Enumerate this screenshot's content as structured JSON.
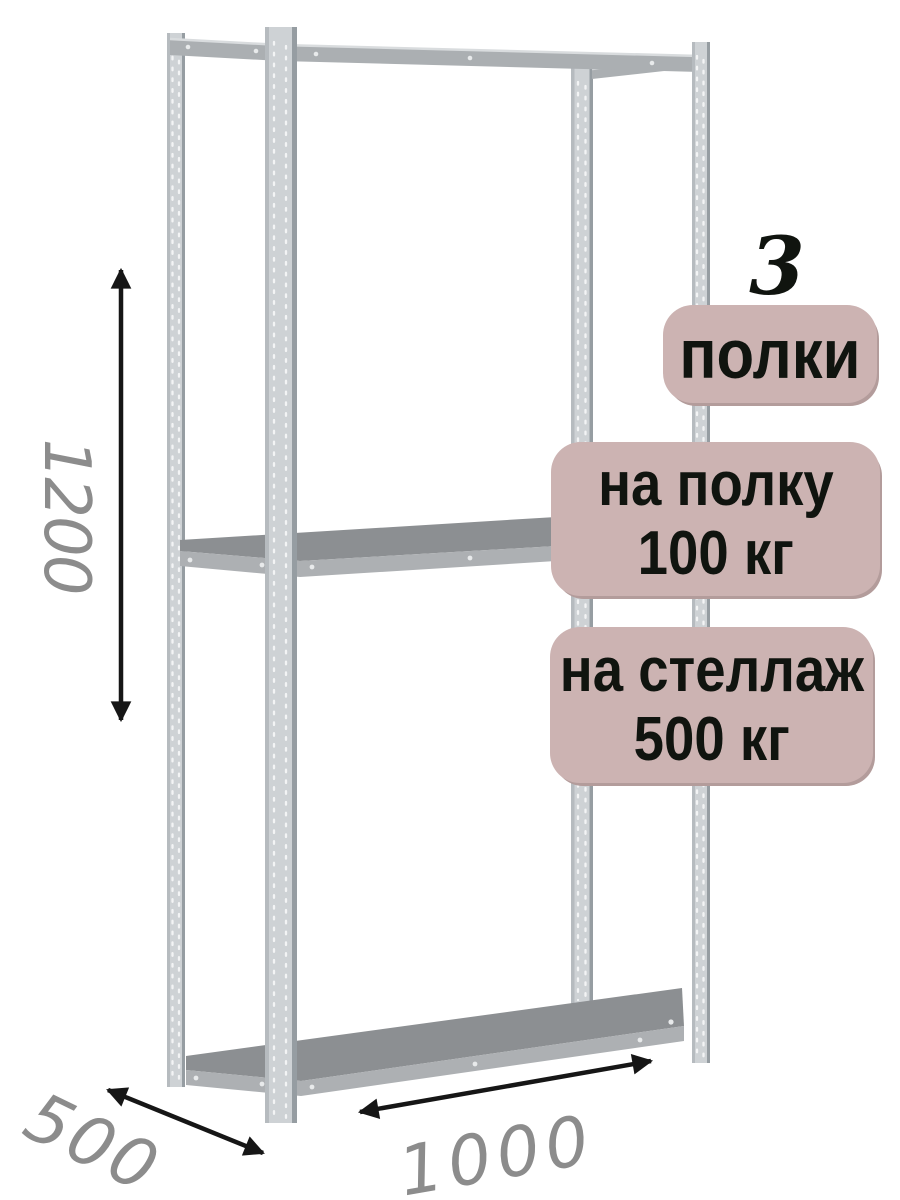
{
  "product": {
    "shelf_count": "3",
    "shelf_count_label": "полки",
    "shelf_load": {
      "line1": "на полку",
      "line2": "100 кг"
    },
    "rack_load": {
      "line1": "на стеллаж",
      "line2": "500 кг"
    }
  },
  "dimensions": {
    "height": "1200",
    "depth": "500",
    "width": "1000"
  },
  "colors": {
    "badge_bg": "#ccb3b2",
    "badge_edge": "#b39c9b",
    "badge_text": "#10140f",
    "dim_text": "#8c8c8c",
    "arrow": "#161616",
    "metal_light": "#ced2d5",
    "metal_edge": "#969da2",
    "metal_edge_light": "#b6bbbf",
    "metal_beam": "#abafb2",
    "metal_beam_light": "#d9dcde",
    "shelf_top": "#8c8f92",
    "shelf_front": "#adb0b3"
  }
}
